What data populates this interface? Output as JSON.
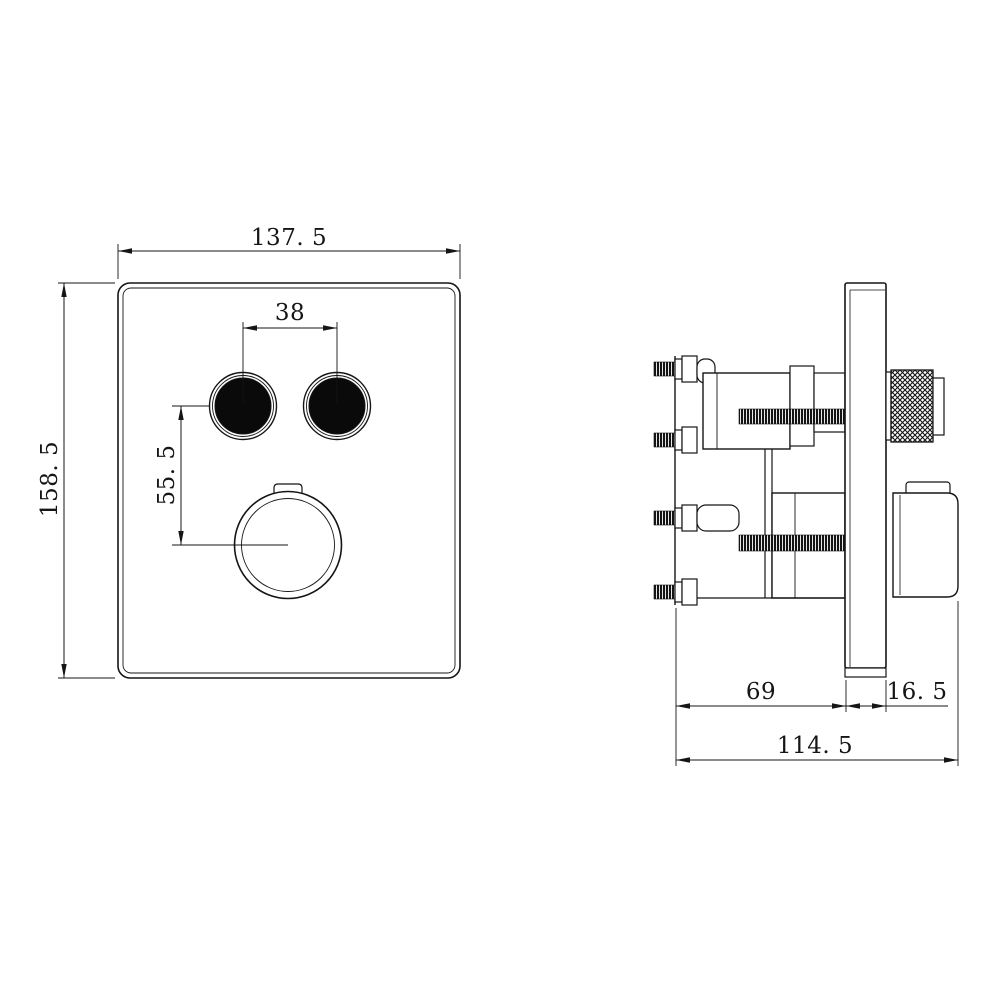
{
  "drawing": {
    "colors": {
      "background": "#ffffff",
      "line": "#151515",
      "button_fill": "#0a0a0a"
    },
    "front_view": {
      "dim_width": "137. 5",
      "dim_height": "158. 5",
      "dim_button_spacing": "38",
      "dim_buttons_to_knob": "55. 5"
    },
    "side_view": {
      "dim_body_depth": "69",
      "dim_trim_depth": "16. 5",
      "dim_total_depth": "114. 5"
    }
  }
}
